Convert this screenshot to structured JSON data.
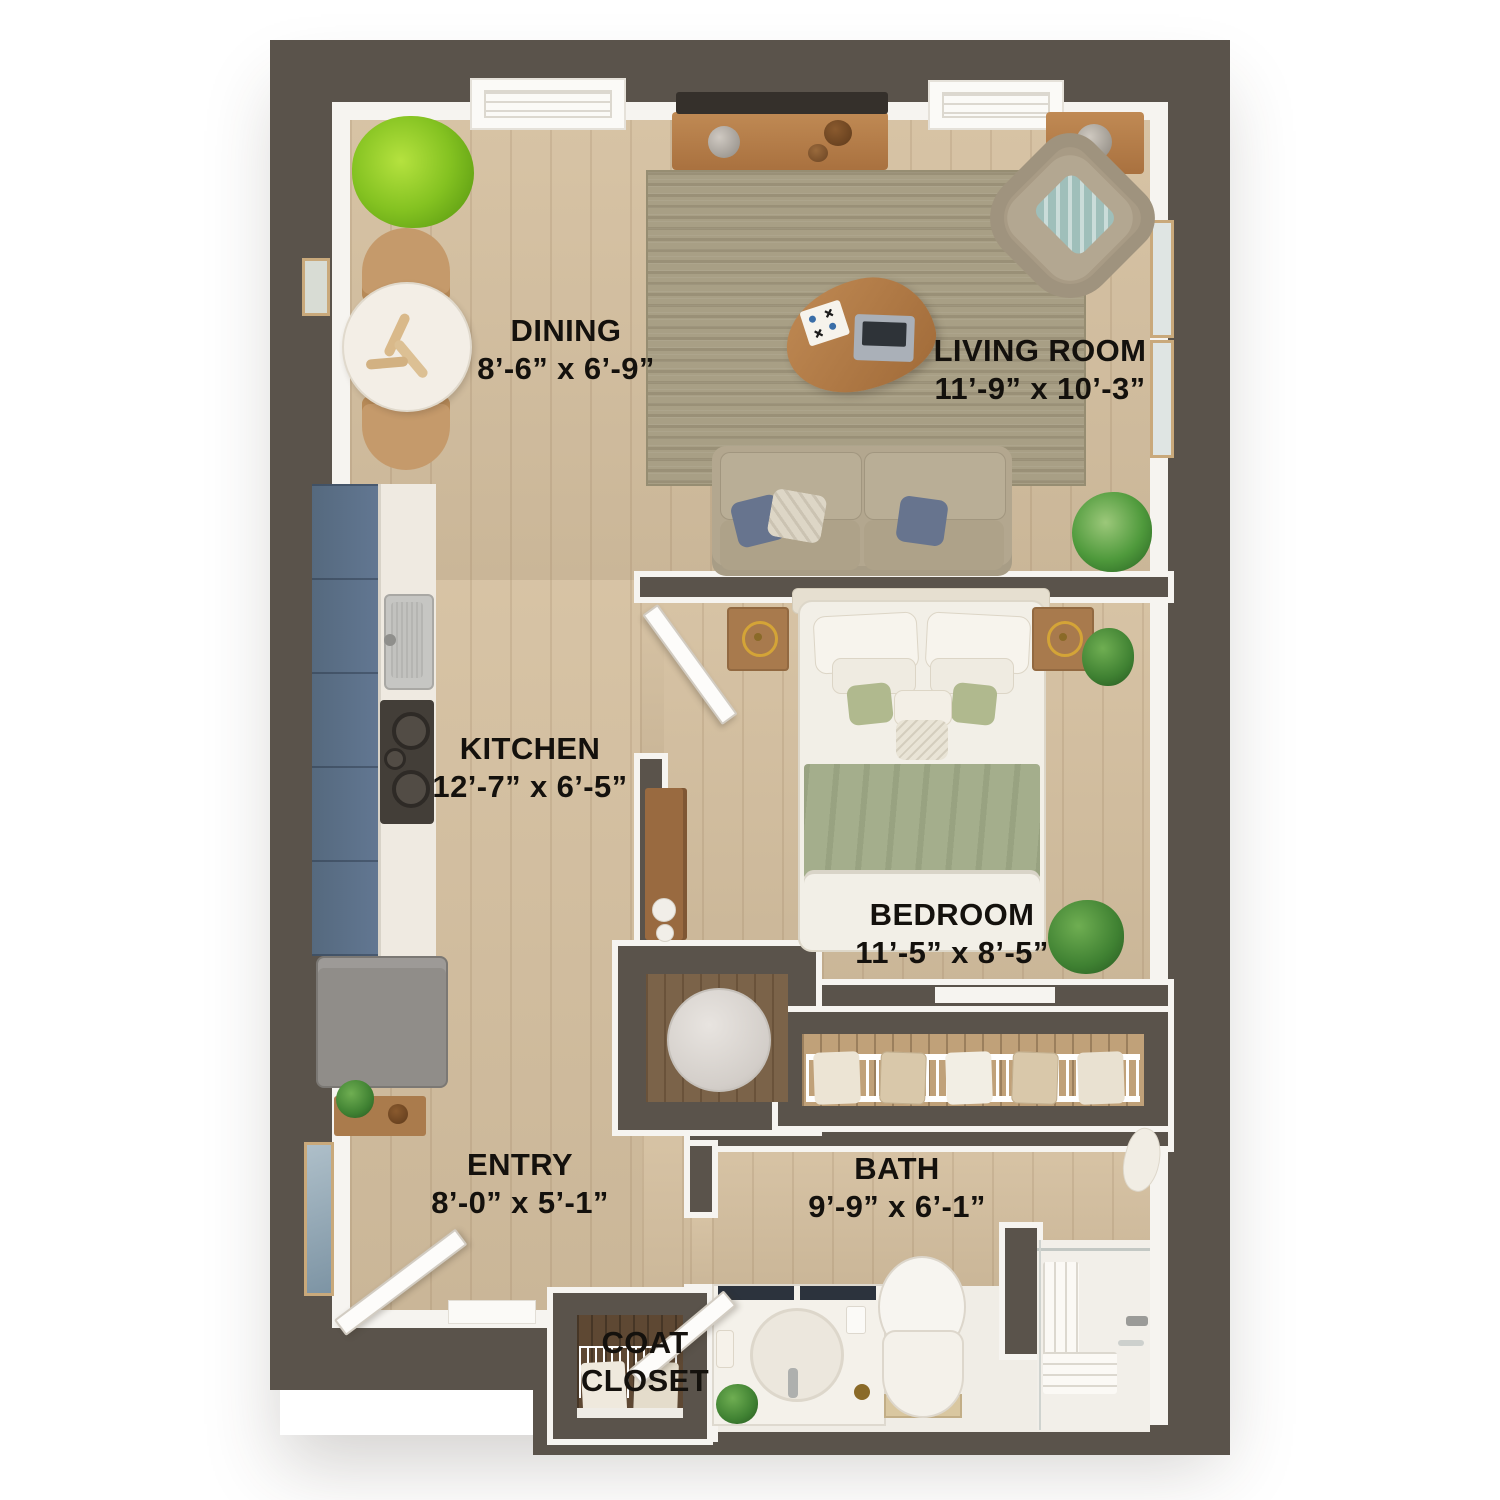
{
  "plan": {
    "type": "floor-plan",
    "rooms": [
      {
        "key": "dining",
        "label": "DINING",
        "dimensions": "8’-6” x 6’-9”"
      },
      {
        "key": "living",
        "label": "LIVING ROOM",
        "dimensions": "11’-9” x 10’-3”"
      },
      {
        "key": "kitchen",
        "label": "KITCHEN",
        "dimensions": "12’-7” x 6’-5”"
      },
      {
        "key": "bedroom",
        "label": "BEDROOM",
        "dimensions": "11’-5” x 8’-5”"
      },
      {
        "key": "entry",
        "label": "ENTRY",
        "dimensions": "8’-0” x 5’-1”"
      },
      {
        "key": "bath",
        "label": "BATH",
        "dimensions": "9’-9” x 6’-1”"
      },
      {
        "key": "coat_closet",
        "label": "COAT CLOSET",
        "label_line1": "COAT",
        "label_line2": "CLOSET"
      }
    ],
    "colors": {
      "wall": "#5a534b",
      "floor_wood": "#d5c0a0",
      "kitchen_cabinet": "#5d7287",
      "rug": "#a89f85",
      "bedding_green": "#a4ae8c",
      "sofa": "#b3a78f",
      "plant_green": "#5a9a26"
    }
  }
}
